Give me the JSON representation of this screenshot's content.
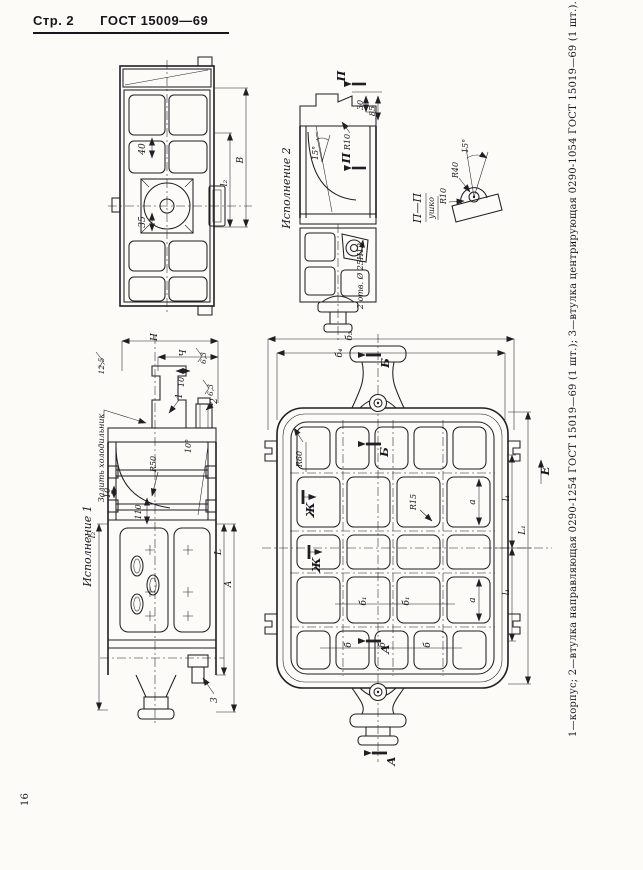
{
  "header": {
    "page_label": "Стр. 2",
    "doc_number": "ГОСТ 15009—69"
  },
  "footer": {
    "page_number": "16"
  },
  "caption": {
    "parts_list": "1—корпус; 2—втулка направляющая 0290-1254 ГОСТ 15019—69 (1 шт.); 3—втулка центрирующая 0290-1054 ГОСТ 15019—69 (1 шт.)."
  },
  "end_view": {
    "dim_40": "40",
    "dim_35": "35",
    "dim_l2": "l₂",
    "dim_B": "В"
  },
  "variant2": {
    "title": "Исполнение 2",
    "section_letter": "П",
    "dim_30": "30",
    "dim_85": "85",
    "radius_r10": "R10",
    "angle_15": "15°",
    "holes_note": "2 отв. Ø 25Н12"
  },
  "lug_detail": {
    "title": "П—П",
    "subtitle": "ушко",
    "radius_r40": "R40",
    "radius_r10": "R10",
    "angle_15": "15°"
  },
  "variant1": {
    "title": "Исполнение 1",
    "chiller_note": "Залить холодильник",
    "roughness_125": "12,5",
    "roughness_63": "6,3",
    "dim_H": "Н",
    "dim_Ch": "Ч",
    "dim_10": "10",
    "dim_110": "110",
    "radius_r50": "R50",
    "angle_10": "10°",
    "dim_l2": "l₂",
    "dim_L": "L",
    "dim_A": "А",
    "ref_1": "1",
    "ref_2": "2",
    "ref_3": "3"
  },
  "plan_view": {
    "dim_b3": "б₃",
    "dim_b4": "б₄",
    "section_B": "Б",
    "section_A": "А",
    "view_Zh": "Ж",
    "view_E": "Е",
    "radius_r60": "R60",
    "radius_r15": "R15",
    "dim_a": "а",
    "dim_b": "б",
    "dim_b1": "б₁",
    "dim_l1": "l₁",
    "dim_L1": "L₁"
  }
}
